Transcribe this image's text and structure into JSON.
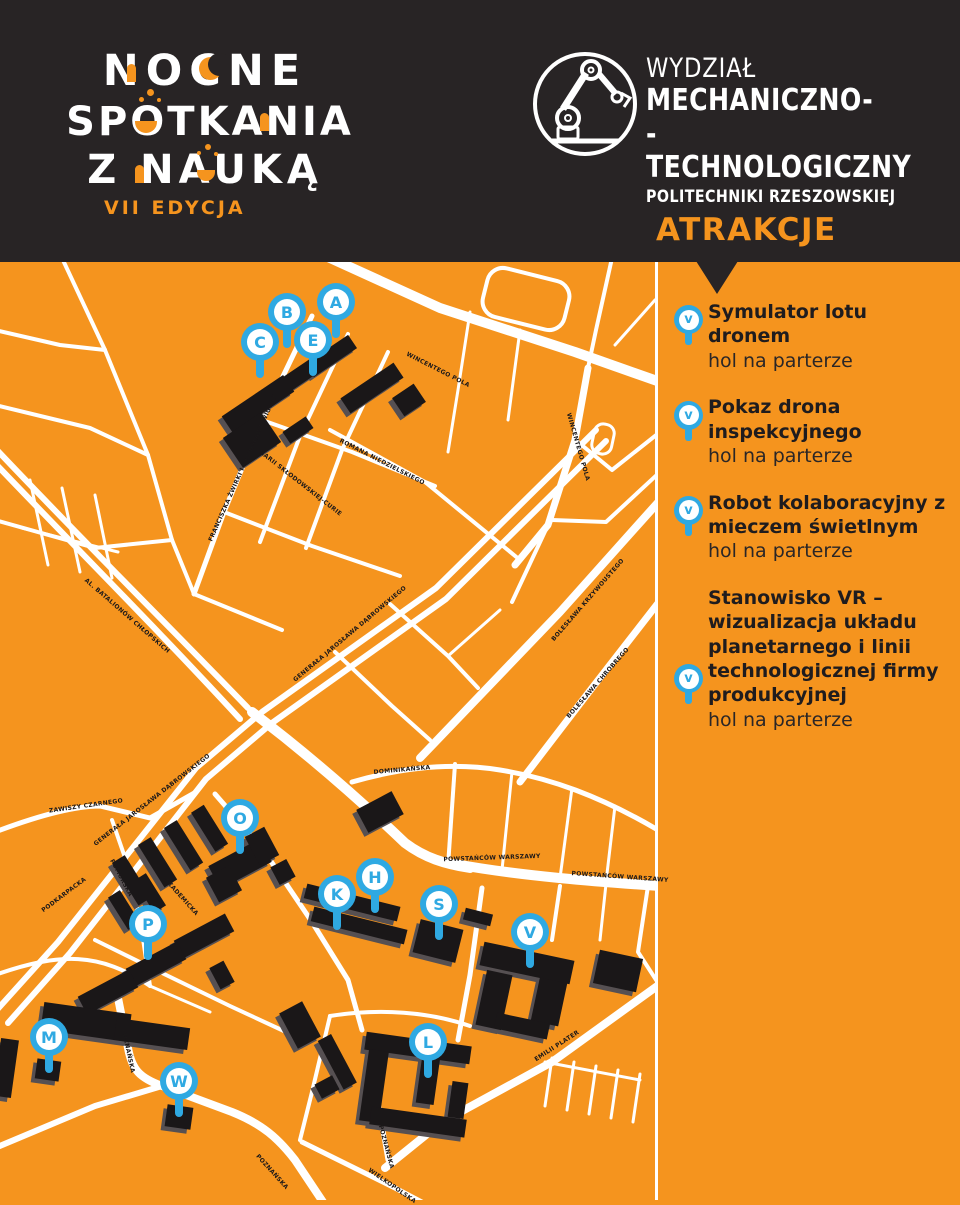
{
  "colors": {
    "background_dark": "#282425",
    "map_orange": "#F5941E",
    "accent_orange": "#F5941E",
    "marker_blue": "#2FA9E2",
    "road_white": "#FFFFFF",
    "building_black": "#1A1718"
  },
  "icons": {
    "faculty_logo": "robot-arm-icon",
    "attraction_pin": "map-pin-icon"
  },
  "header": {
    "title_lines": [
      "NOCNE",
      "SPOTKANIA",
      "Z NAUKĄ"
    ],
    "edition": "VII EDYCJA",
    "faculty": {
      "line1": "WYDZIAŁ",
      "line2": "MECHANICZNO-",
      "line3": "-TECHNOLOGICZNY",
      "line4": "POLITECHNIKI RZESZOWSKIEJ"
    },
    "attractions_heading": "ATRAKCJE"
  },
  "sidebar": {
    "items": [
      {
        "marker": "v",
        "title": "Symulator lotu dronem",
        "location": "hol na parterze"
      },
      {
        "marker": "v",
        "title": "Pokaz drona inspekcyjnego",
        "location": "hol na parterze"
      },
      {
        "marker": "v",
        "title": "Robot kolaboracyjny z mieczem świetlnym",
        "location": "hol na parterze"
      },
      {
        "marker": "v",
        "title": "Stanowisko VR – wizualizacja układu planetarnego i linii technologicznej firmy produkcyjnej",
        "location": "hol na parterze"
      }
    ]
  },
  "map": {
    "markers": [
      {
        "letter": "A",
        "x": 336,
        "y": 302
      },
      {
        "letter": "B",
        "x": 287,
        "y": 312
      },
      {
        "letter": "C",
        "x": 260,
        "y": 342
      },
      {
        "letter": "E",
        "x": 313,
        "y": 340
      },
      {
        "letter": "O",
        "x": 240,
        "y": 818
      },
      {
        "letter": "H",
        "x": 375,
        "y": 877
      },
      {
        "letter": "K",
        "x": 337,
        "y": 894
      },
      {
        "letter": "S",
        "x": 439,
        "y": 904
      },
      {
        "letter": "P",
        "x": 148,
        "y": 924
      },
      {
        "letter": "V",
        "x": 530,
        "y": 932
      },
      {
        "letter": "M",
        "x": 49,
        "y": 1037
      },
      {
        "letter": "L",
        "x": 428,
        "y": 1042
      },
      {
        "letter": "W",
        "x": 179,
        "y": 1081
      }
    ],
    "street_labels": [
      {
        "text": "FRANCISZKA ŻWIRKI I STANISŁAWA WIGURY",
        "x": 243,
        "y": 468,
        "rot": -66
      },
      {
        "text": "MARII SKŁODOWSKIEJ-CURIE",
        "x": 300,
        "y": 483,
        "rot": 38
      },
      {
        "text": "ROMANA NIEDZIELSKIEGO",
        "x": 382,
        "y": 462,
        "rot": 27
      },
      {
        "text": "WINCENTEGO POLA",
        "x": 438,
        "y": 370,
        "rot": 27
      },
      {
        "text": "WINCENTEGO POLA",
        "x": 578,
        "y": 447,
        "rot": 74
      },
      {
        "text": "BOLESŁAWA KRZYWOUSTEGO",
        "x": 588,
        "y": 600,
        "rot": -49
      },
      {
        "text": "BOLESŁAWA CHROBREGO",
        "x": 598,
        "y": 683,
        "rot": -49
      },
      {
        "text": "GENERAŁA JAROSŁAWA DĄBROWSKIEGO",
        "x": 350,
        "y": 634,
        "rot": -40
      },
      {
        "text": "GENERAŁA JAROSŁAWA DĄBROWSKIEGO",
        "x": 152,
        "y": 800,
        "rot": -38
      },
      {
        "text": "AL. BATALIONÓW CHŁOPSKICH",
        "x": 127,
        "y": 616,
        "rot": 41
      },
      {
        "text": "ZAWISZY CZARNEGO",
        "x": 86,
        "y": 806,
        "rot": -8
      },
      {
        "text": "PODKARPACKA",
        "x": 64,
        "y": 895,
        "rot": -37
      },
      {
        "text": "POMORSKA",
        "x": 121,
        "y": 878,
        "rot": 62
      },
      {
        "text": "AKADEMICKA",
        "x": 181,
        "y": 897,
        "rot": 48
      },
      {
        "text": "DOMINIKAŃSKA",
        "x": 402,
        "y": 770,
        "rot": -5
      },
      {
        "text": "POWSTAŃCÓW WARSZAWY",
        "x": 492,
        "y": 858,
        "rot": -2
      },
      {
        "text": "POWSTAŃCÓW WARSZAWY",
        "x": 620,
        "y": 877,
        "rot": 4
      },
      {
        "text": "POZNAŃSKA",
        "x": 128,
        "y": 1051,
        "rot": 78
      },
      {
        "text": "POZNAŃSKA",
        "x": 386,
        "y": 1147,
        "rot": 75
      },
      {
        "text": "POZNAŃSKA",
        "x": 272,
        "y": 1172,
        "rot": 48
      },
      {
        "text": "WIELKOPOLSKA",
        "x": 392,
        "y": 1186,
        "rot": 35
      },
      {
        "text": "EMILII PLATER",
        "x": 557,
        "y": 1046,
        "rot": -33
      }
    ]
  }
}
